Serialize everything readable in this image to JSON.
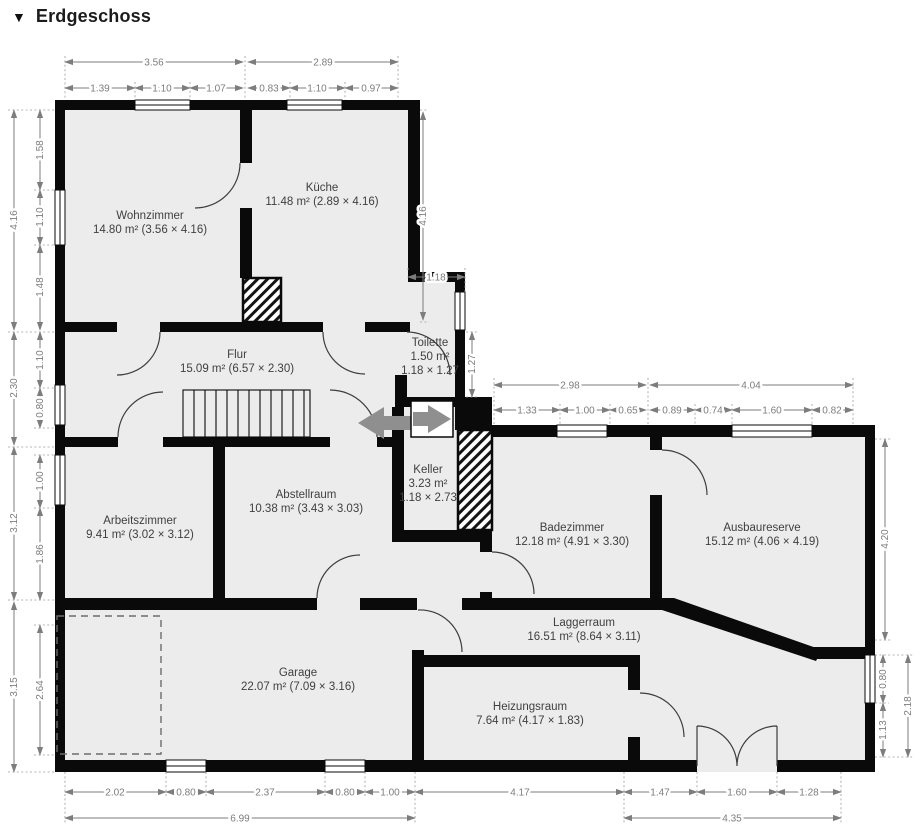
{
  "title": {
    "icon": "▼",
    "text": "Erdgeschoss"
  },
  "colors": {
    "wall": "#0a0a0a",
    "room_fill": "#ececec",
    "dimension_text": "#7d7d7d",
    "label_text": "#3f3f3f",
    "arrow": "#8f8f8f"
  },
  "rooms": [
    {
      "name": "Wohnzimmer",
      "area": "14.80 m² (3.56 × 4.16)"
    },
    {
      "name": "Küche",
      "area": "11.48 m² (2.89 × 4.16)"
    },
    {
      "name": "Flur",
      "area": "15.09 m² (6.57 × 2.30)"
    },
    {
      "name": "Toilette",
      "area": "1.50 m²",
      "size": "1.18 × 1.27"
    },
    {
      "name": "Keller",
      "area": "3.23 m²",
      "size": "1.18 × 2.73"
    },
    {
      "name": "Arbeitszimmer",
      "area": "9.41 m² (3.02 × 3.12)"
    },
    {
      "name": "Abstellraum",
      "area": "10.38 m² (3.43 × 3.03)"
    },
    {
      "name": "Badezimmer",
      "area": "12.18 m² (4.91 × 3.30)"
    },
    {
      "name": "Ausbaureserve",
      "area": "15.12 m² (4.06 × 4.19)"
    },
    {
      "name": "Garage",
      "area": "22.07 m² (7.09 × 3.16)"
    },
    {
      "name": "Laggerraum",
      "area": "16.51 m² (8.64 × 3.11)"
    },
    {
      "name": "Heizungsraum",
      "area": "7.64 m² (4.17 × 1.83)"
    }
  ],
  "dims": {
    "top": [
      "3.56",
      "2.89"
    ],
    "top_sub": [
      "1.39",
      "1.10",
      "1.07",
      "0.83",
      "1.10",
      "0.97"
    ],
    "wing_top": [
      "2.98",
      "4.04"
    ],
    "wing_top_sub": [
      "1.33",
      "1.00",
      "0.65",
      "0.89",
      "0.74",
      "1.60",
      "0.82"
    ],
    "toilette_width": "1.18",
    "bottom": [
      "2.02",
      "0.80",
      "2.37",
      "0.80",
      "1.00",
      "4.17",
      "1.47",
      "1.60",
      "1.28"
    ],
    "bottom_total": [
      "6.99",
      "4.35"
    ],
    "left": [
      "4.16",
      "2.30",
      "3.12",
      "3.15"
    ],
    "left_sub": [
      "1.58",
      "1.10",
      "1.48",
      "1.10",
      "0.80",
      "1.00",
      "1.86",
      "2.64"
    ],
    "right": [
      "4.16",
      "1.27",
      "4.20",
      "0.80",
      "1.13",
      "2.18"
    ]
  }
}
